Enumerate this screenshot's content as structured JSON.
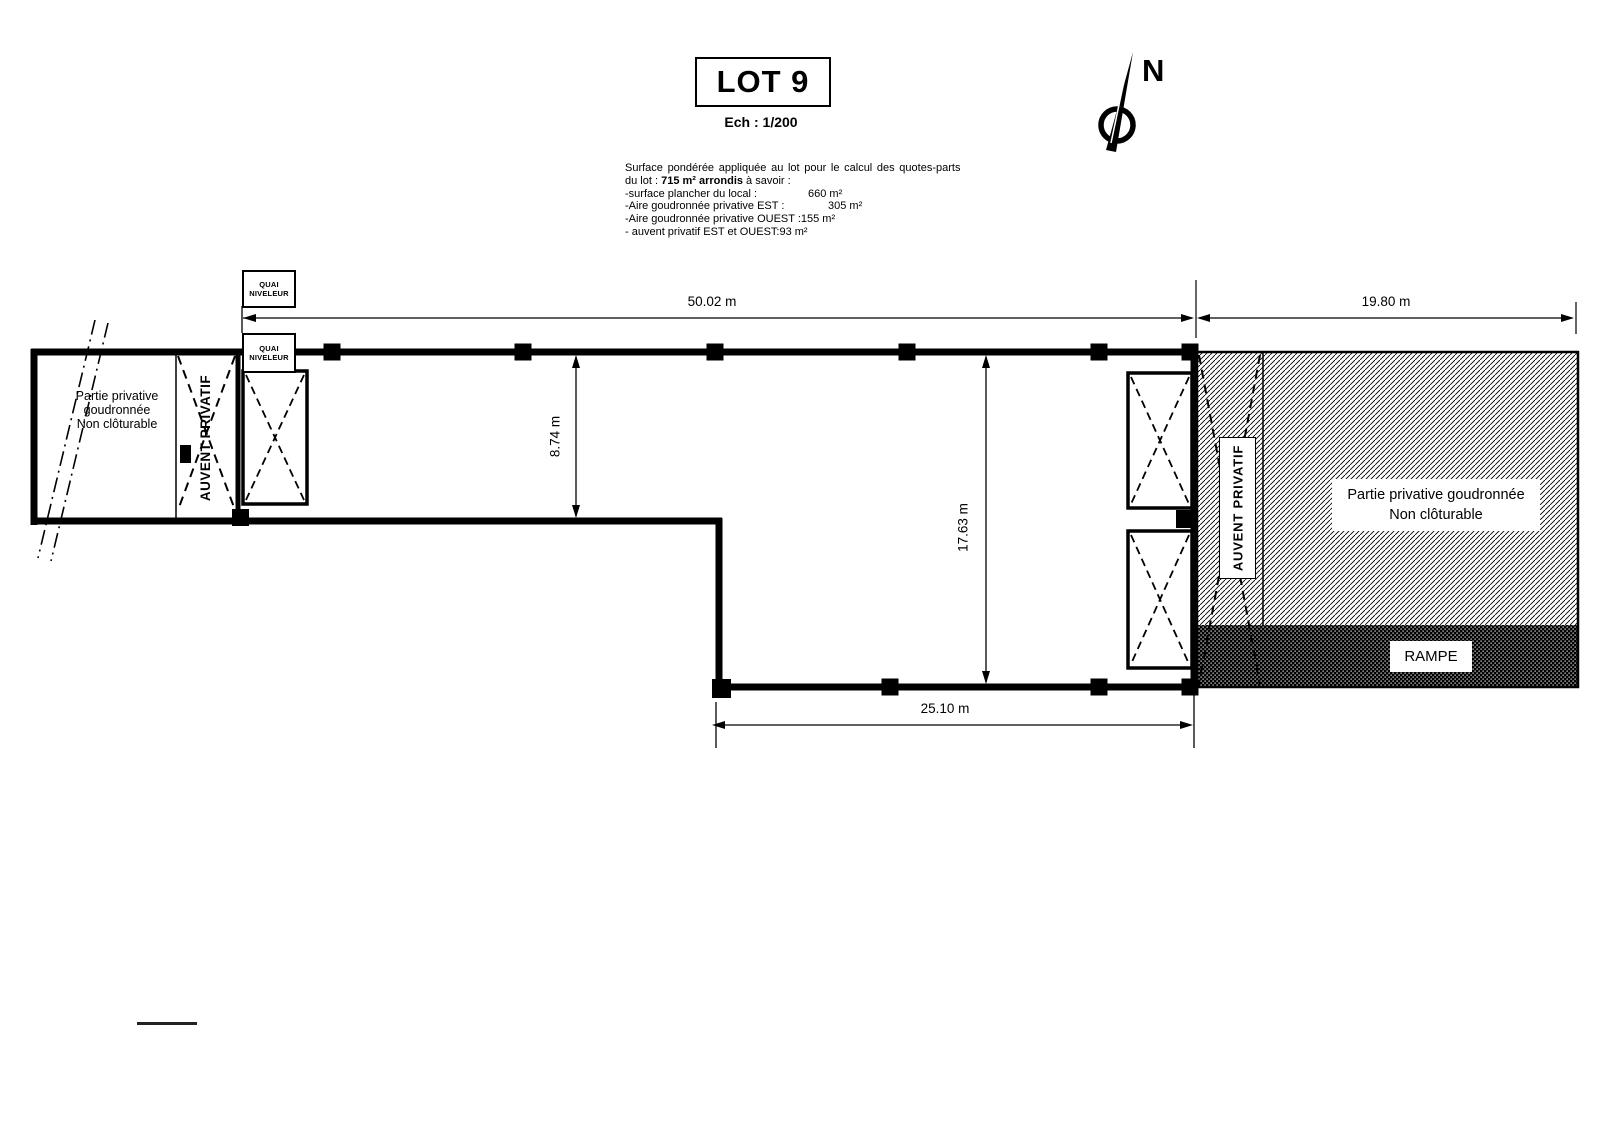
{
  "title": "LOT 9",
  "scale_label": "Ech : 1/200",
  "north_label": "N",
  "surface_note": {
    "line1": "Surface pondérée appliquée au lot pour le calcul des quotes-parts",
    "line2_prefix": "du lot : ",
    "line2_bold": "715 m² arrondis",
    "line2_suffix": "  à savoir :",
    "items": [
      {
        "label": "-surface plancher du local :",
        "value": "660 m²"
      },
      {
        "label": "-Aire goudronnée privative EST :",
        "value": "305 m²"
      },
      {
        "label": "-Aire goudronnée privative OUEST :",
        "value": "155 m²"
      },
      {
        "label": "- auvent privatif EST et OUEST:",
        "value": "93 m²"
      }
    ]
  },
  "plan": {
    "quai_niveleur": {
      "line1": "QUAI",
      "line2": "NIVELEUR"
    },
    "west_area": {
      "line1": "Partie privative",
      "line2": "goudronnée",
      "line3": "Non clôturable"
    },
    "auvent_west": "AUVENT PRIVATIF",
    "auvent_east": "AUVENT PRIVATIF",
    "east_area": {
      "line1": "Partie privative goudronnée",
      "line2": "Non clôturable"
    },
    "rampe": "RAMPE",
    "dimensions": {
      "top_width": "50.02 m",
      "east_width": "19.80 m",
      "west_height": "8.74 m",
      "east_height": "17.63 m",
      "bottom_width": "25.10 m"
    }
  },
  "colors": {
    "ink": "#000000",
    "paper": "#ffffff"
  }
}
